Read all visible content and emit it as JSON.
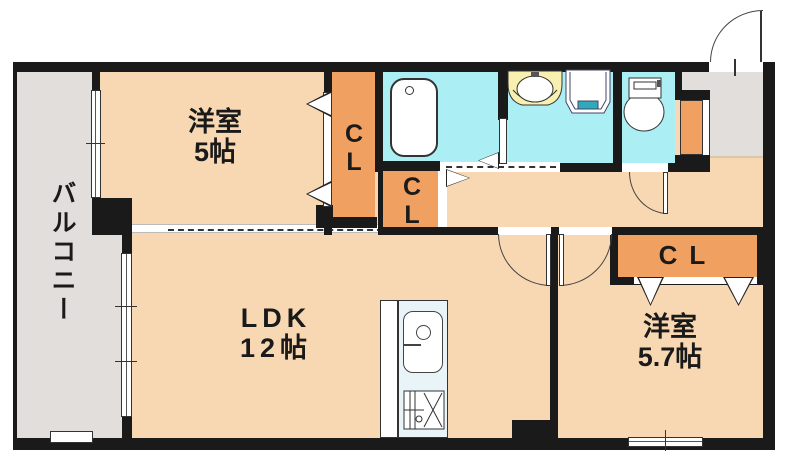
{
  "plan_title": "1LDK apartment floor plan",
  "rooms": {
    "west_bedroom": {
      "name": "洋室",
      "size": "5帖"
    },
    "ldk": {
      "name": "LDK",
      "size": "12帖"
    },
    "east_bedroom": {
      "name": "洋室",
      "size": "5.7帖"
    },
    "balcony": {
      "name": "バルコニー"
    }
  },
  "closets": {
    "west": {
      "line1": "C",
      "line2": "L"
    },
    "hall": {
      "line1": "C",
      "line2": "L"
    },
    "east": {
      "label": "CL"
    }
  },
  "fixtures": {
    "bathtub": "bathtub-icon",
    "washbasin": "washbasin-icon",
    "washing_machine": "washing-machine-pan-icon",
    "toilet": "toilet-icon",
    "kitchen_sink": "kitchen-sink-icon",
    "gas_stove": "gas-stove-icon",
    "shoe_cabinet": "shoe-cabinet-icon"
  },
  "colors": {
    "wall": "#1A1A1A",
    "floor": "#F8D8B3",
    "balcony": "#E2DEDC",
    "water": "#ABEEF4",
    "closet": "#F0A060",
    "counter": "#E8F4F8",
    "teal": "#2FAABC"
  }
}
